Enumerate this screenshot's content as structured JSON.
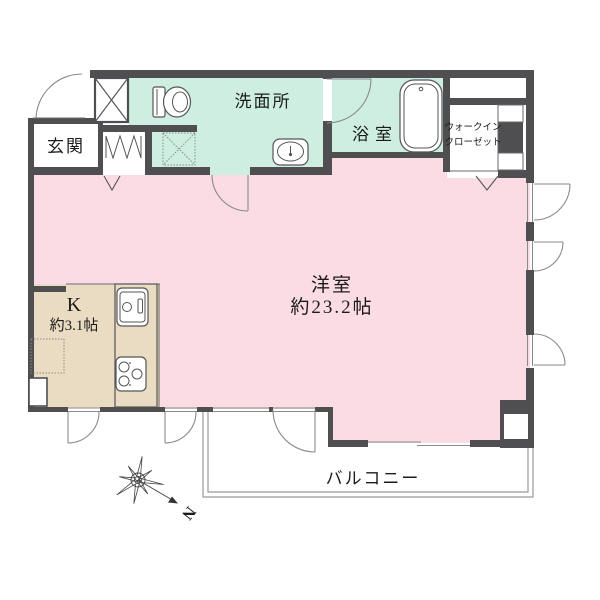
{
  "title": "apartment-floor-plan",
  "colors": {
    "wall": "#4f4f51",
    "room_pink": "#fbdce4",
    "wet_mint": "#cdeee1",
    "kitchen_beige": "#eadcc2",
    "outline_gray": "#8a8a8a",
    "text": "#1b1b1b"
  },
  "rooms": {
    "entrance": {
      "label": "玄関"
    },
    "washroom": {
      "label": "洗面所"
    },
    "bathroom": {
      "label": "浴室"
    },
    "walk_in_closet": {
      "label_line1": "ウォークイン",
      "label_line2": "クローゼット"
    },
    "western_room": {
      "label": "洋室",
      "size": "約23.2帖"
    },
    "kitchen": {
      "label": "K",
      "size": "約3.1帖"
    },
    "balcony": {
      "label": "バルコニー"
    }
  },
  "compass": {
    "north": "N"
  }
}
